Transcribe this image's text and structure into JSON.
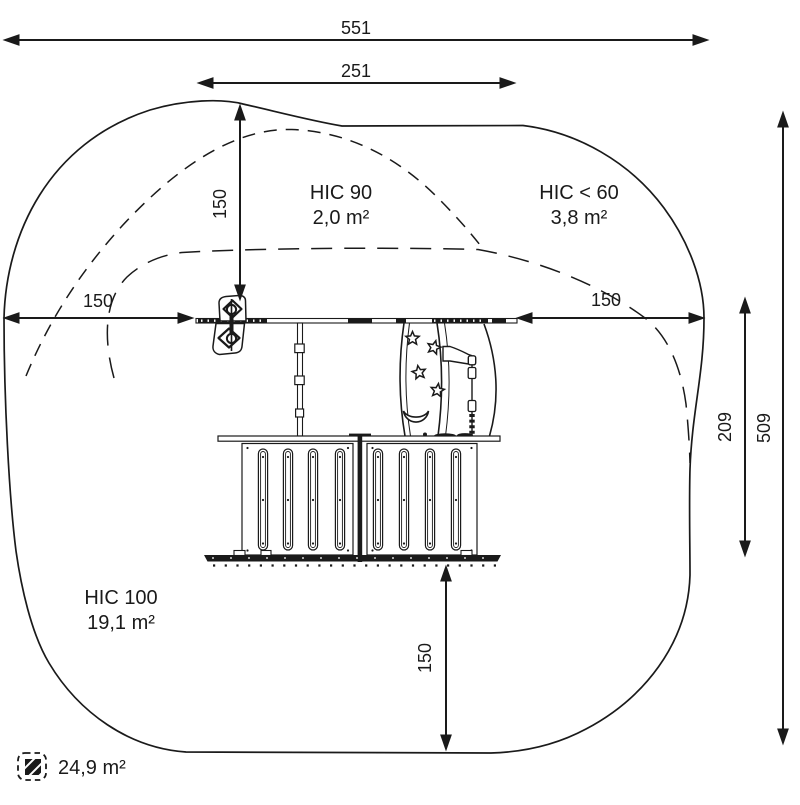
{
  "colors": {
    "ink": "#1a1a1a",
    "background": "#ffffff"
  },
  "dimensions": {
    "total_width": "551",
    "platform_width": "251",
    "top_clearance": "150",
    "left_clearance": "150",
    "right_clearance": "150",
    "bottom_clearance": "150",
    "equipment_height": "209",
    "total_height": "509"
  },
  "zones": {
    "hic90": {
      "label": "HIC 90",
      "area": "2,0 m²"
    },
    "hic60": {
      "label": "HIC < 60",
      "area": "3,8 m²"
    },
    "hic100": {
      "label": "HIC 100",
      "area": "19,1 m²"
    }
  },
  "footprint": {
    "area": "24,9 m²"
  }
}
